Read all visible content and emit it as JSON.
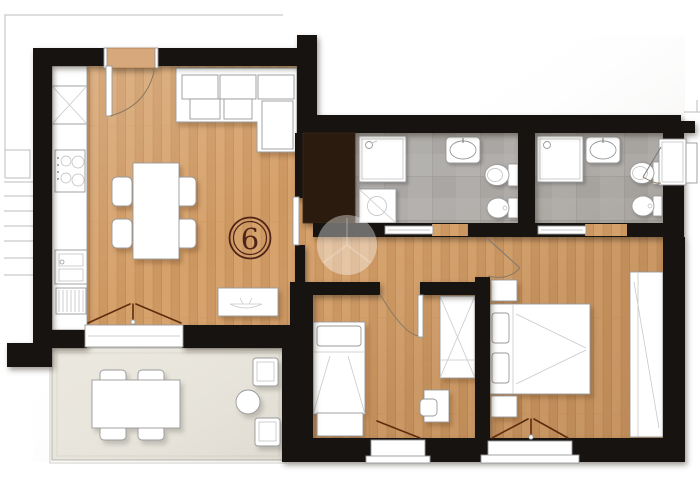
{
  "page": {
    "background": "#ffffff",
    "width": 700,
    "height": 494
  },
  "plan": {
    "unit_number": "6",
    "colors": {
      "wall": "#171310",
      "wood": "#d6a26c",
      "wood_dark": "#c38c55",
      "wood_line": "#b07c46",
      "tile": "#b0adaa",
      "tile_line": "#9b9895",
      "terrace": "#eae7de",
      "terrace_line": "#b8b6ad",
      "closet_dark": "#2a1b0e",
      "furniture": "#ffffff",
      "furniture_line": "#9a9a9a",
      "door_leaf": "#5f2d0e",
      "entrance_door": "#d7a87b",
      "badge": "#4f2317",
      "exterior_line": "#c9c9c9",
      "watermark": "#ffffff"
    },
    "depicted": {
      "rooms": [
        "living-room-with-kitchen",
        "hallway",
        "bathroom-left",
        "bathroom-right",
        "bedroom",
        "master-bedroom",
        "terrace"
      ],
      "symbols": [
        "fridge",
        "stove",
        "kitchen-sink",
        "dishwasher",
        "corner-sofa",
        "dining-table-with-4-chairs",
        "media-console",
        "entrance-door",
        "terrace-french-door",
        "shower",
        "washing-machine",
        "washbasin",
        "toilet",
        "bidet",
        "sliding-doors",
        "single-bed",
        "dresser",
        "wardrobe",
        "desk-with-chair",
        "double-bed",
        "nightstands",
        "bedroom-window",
        "bathroom-window",
        "outdoor-dining-table-with-4-chairs",
        "outdoor-armchairs",
        "outdoor-side-table",
        "unit-number-badge",
        "photo-watermark",
        "staircase-outline"
      ]
    }
  }
}
